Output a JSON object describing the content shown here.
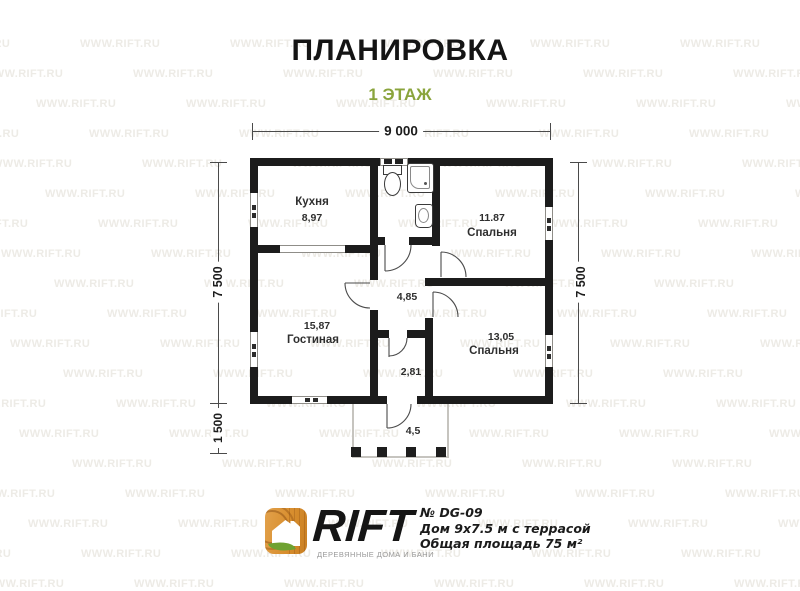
{
  "title": "ПЛАНИРОВКА",
  "subtitle": "1 ЭТАЖ",
  "colors": {
    "subtitle_green": "#8aa43c",
    "wall": "#1c1c1c",
    "logo_orange": "#d8912f",
    "leaf_green": "#6fa231"
  },
  "dimensions": {
    "width_top": "9 000",
    "height_left": "7 500",
    "height_right": "7 500",
    "terrace_depth": "1 500"
  },
  "rooms": {
    "kitchen": {
      "name": "Кухня",
      "area": "8,97"
    },
    "bedroom1": {
      "name": "Спальня",
      "area": "11.87"
    },
    "living": {
      "name": "Гостиная",
      "area": "15,87"
    },
    "bedroom2": {
      "name": "Спальня",
      "area": "13,05"
    },
    "hallway": {
      "area": "4,85"
    },
    "corridor": {
      "area": "2,81"
    },
    "terrace": {
      "area": "4,5"
    }
  },
  "watermark": {
    "text": "WWW.RIFT.RU"
  },
  "footer": {
    "brand": "RIFT",
    "tagline": "ДЕРЕВЯННЫЕ ДОМА И БАНИ",
    "model": "№ DG-09",
    "description": "Дом 9х7.5 м с террасой",
    "total_area": "Общая площадь 75 м²"
  }
}
